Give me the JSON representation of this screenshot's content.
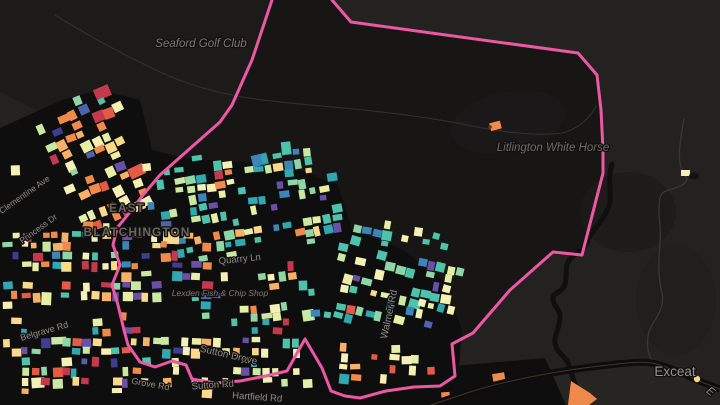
{
  "map": {
    "title_labels": {
      "golf_club": "Seaford Golf Club",
      "white_horse": "Litlington White Horse",
      "locality_top": "EAST",
      "locality_bottom": "BLATCHINGTON",
      "village": "Exceat",
      "partial_road": "E",
      "chip_shop": "Lexden Fish & Chip Shop"
    },
    "street_labels": [
      {
        "text": "Clementine Ave",
        "x": 26,
        "y": 197,
        "rot": -35,
        "size": 8.5
      },
      {
        "text": "Princess Dr",
        "x": 40,
        "y": 231,
        "rot": -36,
        "size": 8.5
      },
      {
        "text": "Belgrave Rd",
        "x": 45,
        "y": 334,
        "rot": -16,
        "size": 9
      },
      {
        "text": "Grove Rd",
        "x": 150,
        "y": 387,
        "rot": 10,
        "size": 9
      },
      {
        "text": "Sutton Drove",
        "x": 228,
        "y": 358,
        "rot": 13,
        "size": 10
      },
      {
        "text": "Sutton Rd",
        "x": 213,
        "y": 388,
        "rot": -4,
        "size": 9.5
      },
      {
        "text": "Hartfield Rd",
        "x": 257,
        "y": 400,
        "rot": 4,
        "size": 9.5
      },
      {
        "text": "Walmer Rd",
        "x": 392,
        "y": 315,
        "rot": -78,
        "size": 10
      },
      {
        "text": "Quarry Ln",
        "x": 240,
        "y": 262,
        "rot": -6,
        "size": 9.5
      }
    ],
    "colors": {
      "boundary": "#ec58a4",
      "bg_outer": "#242220",
      "bg_inner": "#171615",
      "bg_golf": "#1d1b1a",
      "bg_town": "#0f0e0e",
      "bg_patch": "#1d1b1a",
      "bg_corner": "#272522",
      "trail": "#33302c",
      "road": "#3a3633",
      "road_major": "#0e0d0c",
      "road_center": "#3a3631",
      "river": "#100f0e",
      "label_poi": "#7c7977",
      "label_poi_dim": "#6e6a67",
      "label_small_poi": "#7b7773",
      "label_locality": "#6b665e",
      "label_village": "#969390",
      "label_partial": "#8a8683",
      "label_street": "#8f8b87",
      "label_halo": "#121110",
      "marker_yellow": "#f6d87c",
      "marker_orange": "#ef8a4b",
      "marker_tip": "#5f3317",
      "bush": "#131211",
      "isolated_parcel": "#f5f1b5"
    },
    "palette": [
      "#c4394e",
      "#e35b44",
      "#ef8a4b",
      "#f7b267",
      "#fbd98b",
      "#f5f1b5",
      "#e7efa6",
      "#c9e8a2",
      "#8fd6a6",
      "#4ec3ab",
      "#2fa8b0",
      "#3b86b8",
      "#4f63ad",
      "#6a4fa8",
      "#403d90"
    ],
    "weights": {
      "warm": [
        7,
        7,
        11,
        9,
        7,
        12,
        5,
        2,
        1,
        2,
        1,
        1,
        1,
        2,
        1
      ],
      "cool": [
        1,
        1,
        2,
        1,
        2,
        9,
        8,
        6,
        9,
        13,
        11,
        4,
        2,
        2,
        1
      ],
      "mixed": [
        4,
        3,
        6,
        5,
        5,
        11,
        7,
        4,
        4,
        6,
        4,
        2,
        2,
        3,
        1
      ],
      "orange": [
        1,
        3,
        14,
        9,
        5,
        3,
        1,
        0,
        0,
        0,
        0,
        0,
        0,
        0,
        0
      ],
      "yellowwarm": [
        2,
        2,
        6,
        6,
        7,
        14,
        8,
        3,
        1,
        2,
        1,
        0,
        0,
        1,
        0
      ]
    },
    "clusters": [
      {
        "x": 58,
        "y": 92,
        "w": 90,
        "h": 145,
        "rot": -24,
        "cell": 11,
        "skip": 0.3,
        "weights": "warm"
      },
      {
        "x": 150,
        "y": 148,
        "w": 190,
        "h": 117,
        "rot": -9,
        "cell": 10,
        "skip": 0.4,
        "weights": "cool"
      },
      {
        "x": 2,
        "y": 222,
        "w": 238,
        "h": 100,
        "rot": 0,
        "cell": 10,
        "skip": 0.42,
        "weights": "mixed"
      },
      {
        "x": 240,
        "y": 262,
        "w": 95,
        "h": 75,
        "rot": -5,
        "cell": 10,
        "skip": 0.42,
        "weights": "cool"
      },
      {
        "x": 2,
        "y": 318,
        "w": 330,
        "h": 86,
        "rot": 0,
        "cell": 10,
        "skip": 0.4,
        "weights": "mixed"
      },
      {
        "x": 332,
        "y": 225,
        "w": 132,
        "h": 122,
        "rot": 12,
        "cell": 10,
        "skip": 0.42,
        "weights": "cool"
      },
      {
        "x": 330,
        "y": 345,
        "w": 108,
        "h": 58,
        "rot": 2,
        "cell": 10,
        "skip": 0.42,
        "weights": "yellowwarm"
      },
      {
        "x": 428,
        "y": 362,
        "w": 112,
        "h": 42,
        "rot": -6,
        "cell": 13,
        "skip": 0.22,
        "weights": "orange"
      },
      {
        "x": 0,
        "y": 132,
        "w": 24,
        "h": 96,
        "rot": 0,
        "cell": 11,
        "skip": 0.52,
        "weights": "mixed"
      }
    ],
    "boundary_path": "M332,0 L351,22 L578,53 L597,75 L601,110 L603,150 L603,173 L582,255 L553,252 L510,290 L473,333 L452,344 L455,376 L440,386 L414,387 L386,391 L360,398 L345,396 L331,391 L322,368 L305,339 L287,371 L266,376 L240,381 L215,383 L192,379 L186,365 L172,361 L155,367 L140,362 L128,345 L124,330 L118,305 L112,285 L120,265 L113,245 L117,228 L130,212 L143,195 L160,175 L220,122 L232,105 L252,60 L272,0",
    "boundary_fill": "M332,0 L351,22 L578,53 L597,75 L601,110 L603,150 L603,173 L582,255 L553,252 L510,290 L473,333 L452,344 L455,376 L440,386 L414,387 L386,391 L360,398 L345,396 L331,391 L322,368 L305,339 L287,371 L266,376 L240,381 L215,383 L192,379 L186,365 L172,361 L155,367 L140,362 L128,345 L124,330 L118,305 L112,285 L120,265 L113,245 L117,228 L130,212 L143,195 L160,175 L220,122 L232,105 L252,60 L272,0 Z",
    "paths": {
      "golf_poly": "M0,0 L272,0 L252,60 L232,105 L220,122 L160,175 L105,148 L40,112 L0,92 Z",
      "town_blob": "M0,128 L62,100 L100,90 L140,100 L152,150 L185,158 L240,162 L300,170 L338,185 L352,230 L400,248 L445,282 L462,330 L458,378 L440,400 L430,405 L0,405 Z",
      "se_backdrop": "M424,405 L430,368 L545,358 L566,405 Z",
      "corner_poly": "M430,405 L470,392 C510,380 555,371 600,366 L648,362 L668,370 L700,381 L720,388 L720,405 Z",
      "trail1": "M55,15 C95,40 125,55 160,72 C210,95 255,100 310,105 C370,110 430,117 472,126 C505,133 540,136 562,133",
      "trail2": "M562,133 C580,128 590,118 596,106",
      "road_right": "M684,118 C679,148 676,164 686,177 C690,184 676,188 666,191 C658,193 658,208 660,226 C662,244 655,266 662,293 C666,312 650,322 648,336 C646,351 650,358 655,364",
      "road_major": "M428,406 L470,392 C505,381 555,371 600,366 C625,363 642,361 652,363 C668,366 688,376 704,383 L720,389",
      "river": "M612,164 C606,184 614,196 608,208 C602,224 591,230 588,240 C585,249 578,252 572,257 C563,265 568,274 565,284 C562,294 553,291 553,299 C553,307 561,309 560,318 C559,330 554,335 555,343 C556,353 565,355 568,363 C572,373 573,380 576,387 C578,392 581,398 585,403",
      "orange_wedge": "M571,381 L590,393 L597,399 L589,405 L568,405 Z"
    },
    "markers": {
      "exceat_dot": {
        "x": 697,
        "y": 379,
        "r": 3.2
      },
      "litlington_parcel": {
        "x": 490,
        "y": 122,
        "w": 11,
        "h": 8,
        "rot": -15
      },
      "isolated_parcel": {
        "x": 681,
        "y": 170,
        "w": 9,
        "h": 6
      },
      "bush": {
        "x": 694,
        "y": 176,
        "rx": 5,
        "ry": 3.5
      }
    }
  }
}
